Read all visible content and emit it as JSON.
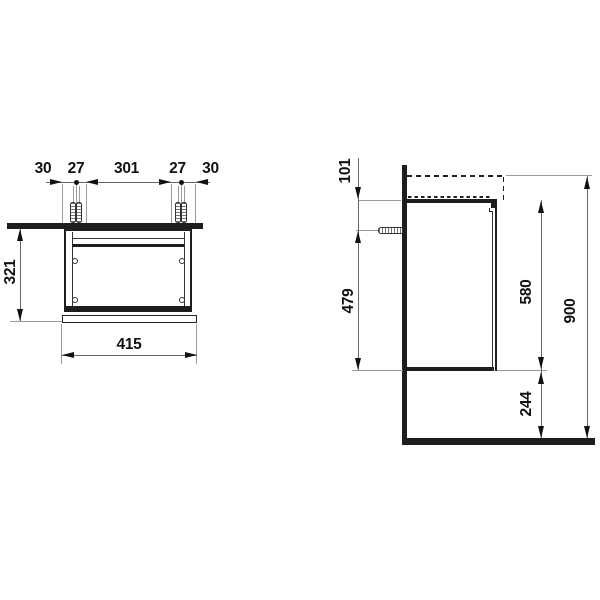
{
  "front_view": {
    "top_dims": [
      "30",
      "27",
      "301",
      "27",
      "30"
    ],
    "height": "321",
    "width": "415"
  },
  "side_view": {
    "top_clearance": "101",
    "fixing_height": "479",
    "cabinet_height": "580",
    "floor_clearance": "244",
    "total_height": "900"
  },
  "colors": {
    "line": "#1e1e1e",
    "extension_line": "#9a9a9a",
    "dimension_line": "#666666",
    "text": "#111111",
    "background": "#ffffff"
  }
}
